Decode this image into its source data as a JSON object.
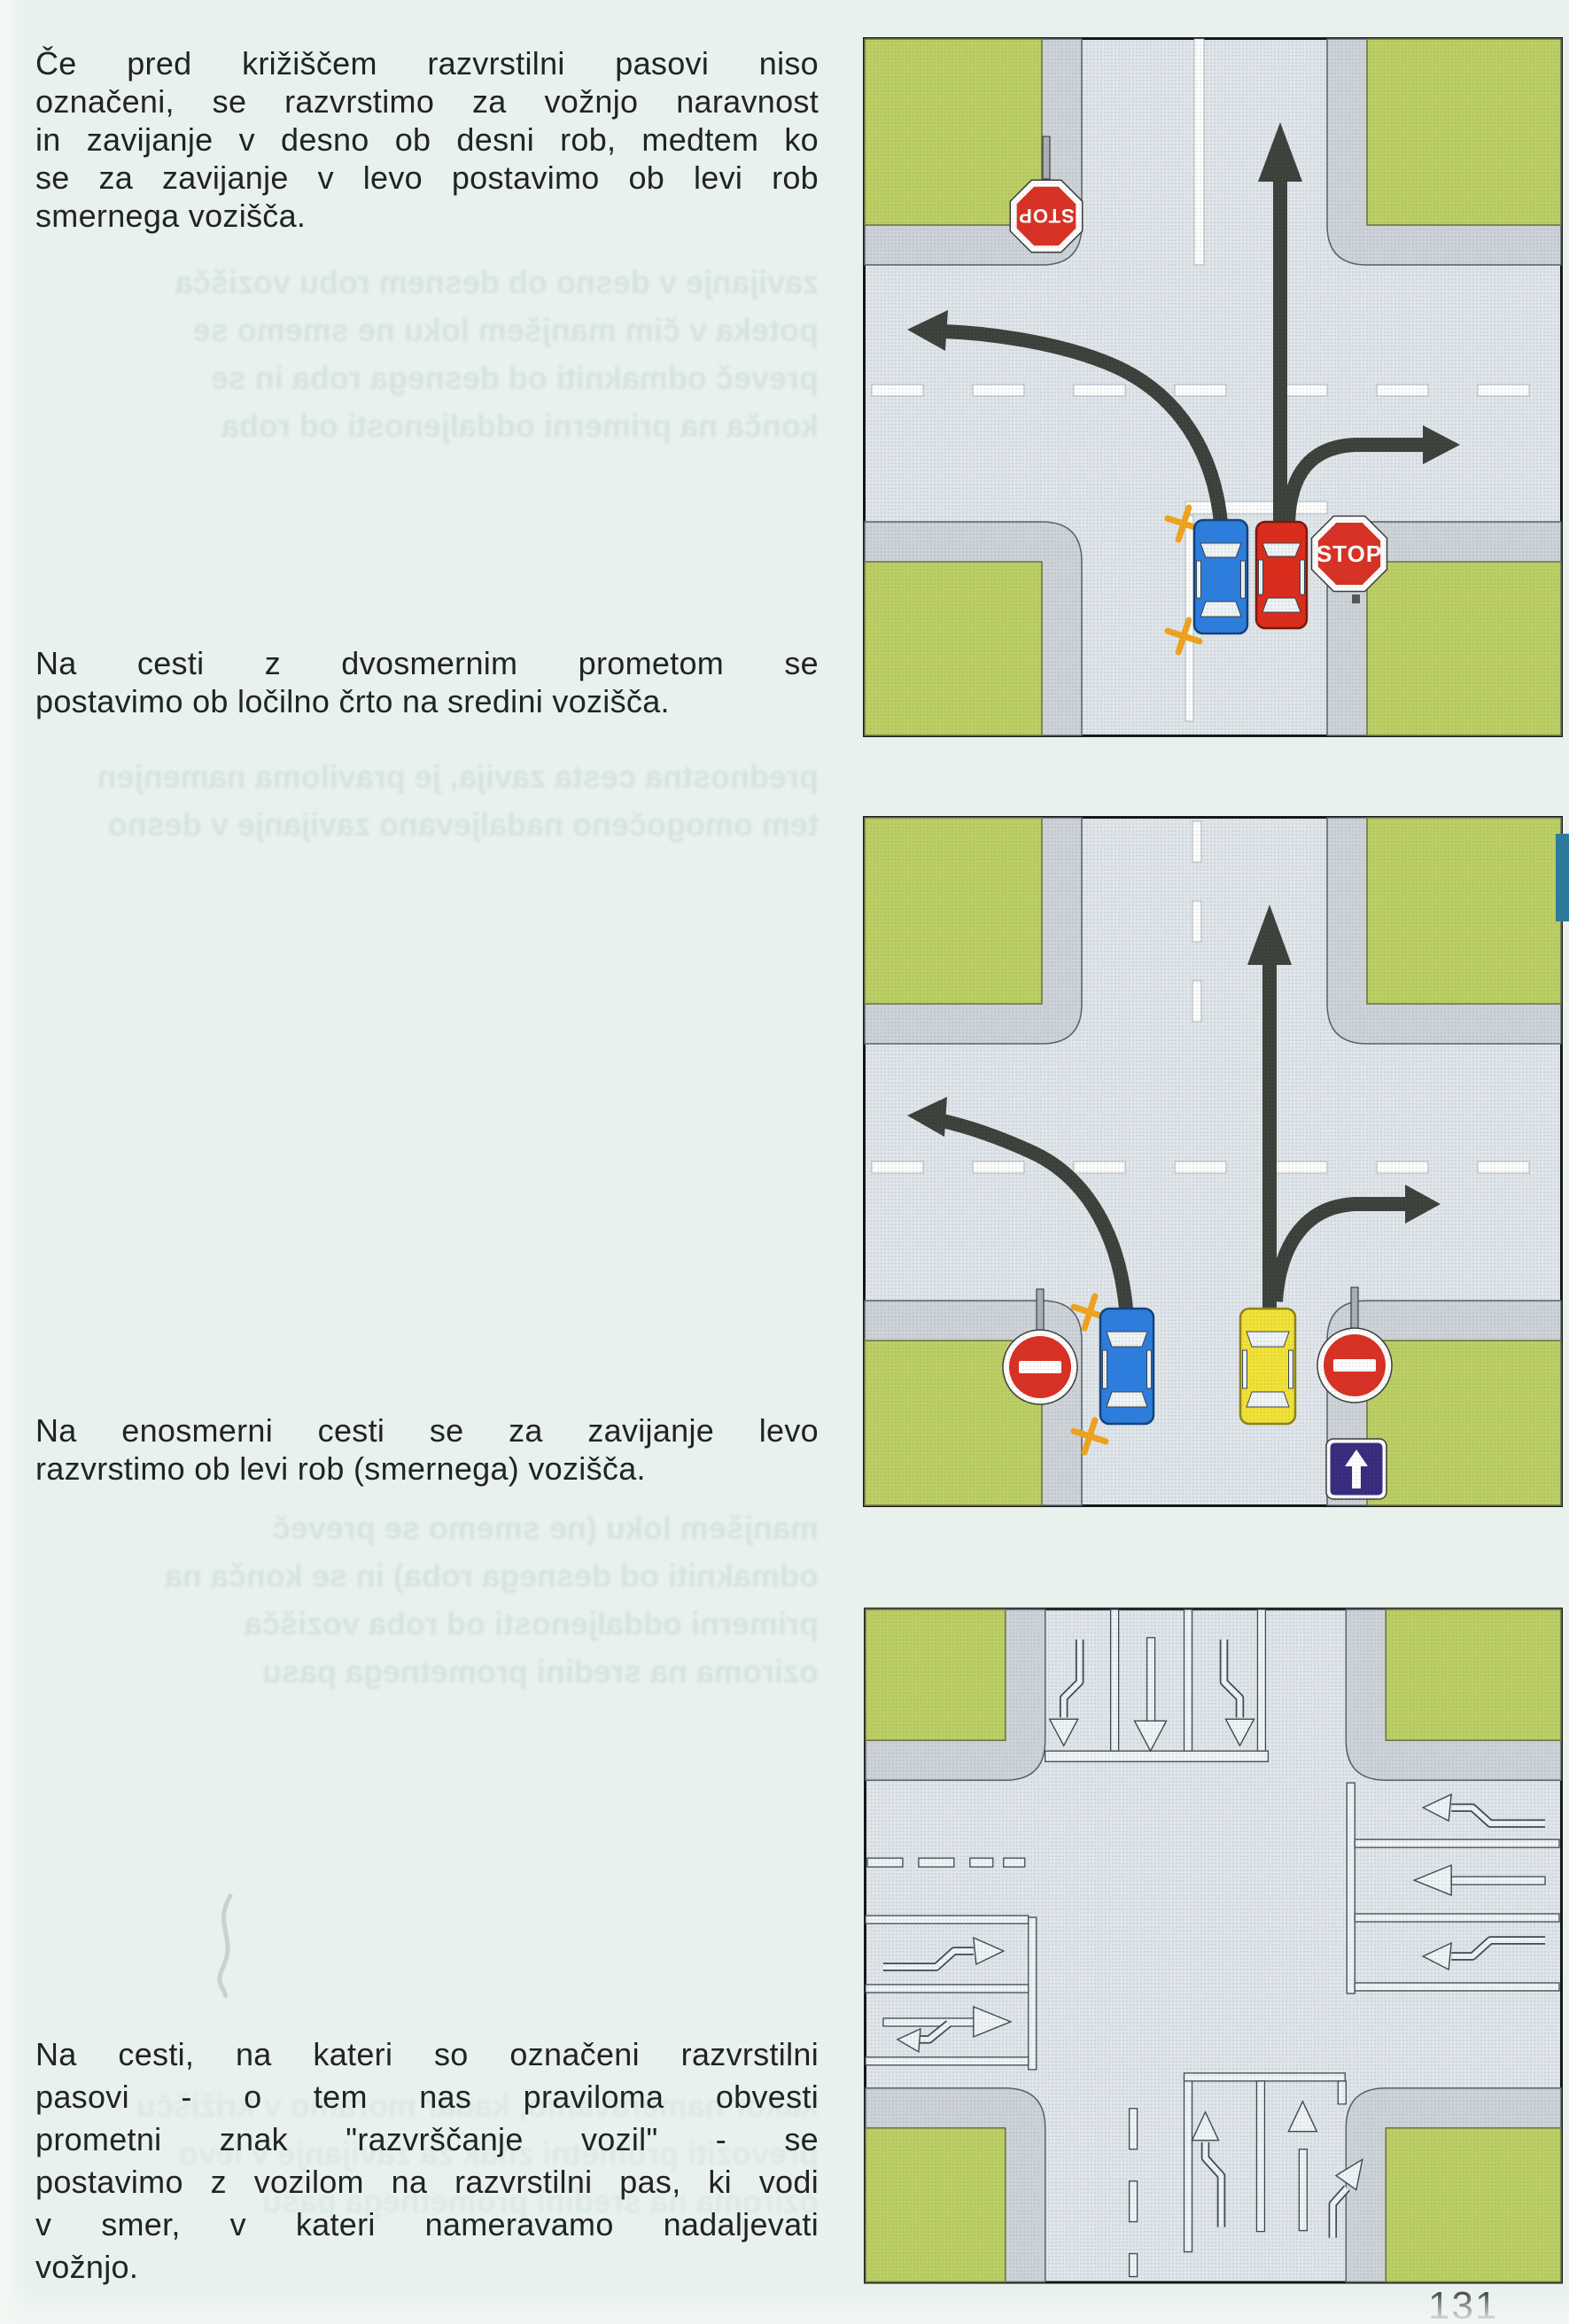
{
  "page": {
    "number": "131"
  },
  "colors": {
    "page_bg": "#e8f1ec",
    "text": "#212326",
    "ghost": "#c6dad2",
    "grass": "#bccf63",
    "road": "#dfe5ea",
    "sidewalk": "#cdd3d8",
    "arrow": "#3b403b",
    "stop_red": "#da2f23",
    "car_blue": "#2b7ddf",
    "car_red": "#dd2a1a",
    "car_yellow": "#f2e236",
    "one_way_blue": "#372a7e",
    "marking": "#eef3f6",
    "marking_edge": "#3f4752",
    "cross": "#f2a31d",
    "line_white": "#fdfdfd",
    "tab": "#2d7a9e"
  },
  "paragraphs": [
    {
      "lines": [
        "Če pred križiščem razvrstilni pasovi niso",
        "označeni, se razvrstimo za vožnjo naravnost",
        "in zavijanje v desno ob desni rob, medtem ko",
        "se za zavijanje v levo postavimo ob levi rob",
        "smernega vozišča."
      ]
    },
    {
      "lines": [
        "Na cesti z dvosmernim prometom se",
        "postavimo ob ločilno črto na sredini vozišča."
      ]
    },
    {
      "lines": [
        "Na enosmerni cesti se za zavijanje levo",
        "razvrstimo ob levi rob (smernega) vozišča."
      ]
    },
    {
      "lines": [
        "Na cesti, na kateri so označeni razvrstilni",
        "pasovi - o tem nas praviloma obvesti",
        "prometni znak \"razvrščanje vozil\" - se",
        "postavimo z vozilom na razvrstilni pas, ki vodi",
        "v smer, v kateri nameravamo nadaljevati",
        "vožnjo."
      ]
    }
  ],
  "ghosts": {
    "note": "faint mirrored bleed-through print from reverse side of the scanned page",
    "g1": [
      "zavijanje v desno ob desnem robu vozišča",
      "poteka v čim manjšem loku ne smemo se",
      "preveč odmakniti od desnega roba in se",
      "konča na primerni oddaljenosti od roba"
    ],
    "g2": [
      "prednostna cesta zavija, je praviloma namenjen",
      "tem omogočeno nadaljevano zavijanje v desno"
    ],
    "g3": [
      "manjšem loku (ne smemo se preveč",
      "odmakniti od desnega roba) in se konča na",
      "primerni oddaljenosti od roba vozišča",
      "oziroma na sredini prometnega pasu"
    ],
    "g4": [
      "kakor nameravamo, kadar moramo v križišču",
      "prevoziti prometni znak za zavijanje v levo",
      "oziroma na sredini prometnega pasu"
    ]
  },
  "diagrams": [
    {
      "name": "two-way road, unmarked lanes: blue car keeps left of centre for left turn, red car at right edge for straight/right",
      "signs": {
        "top": "STOP",
        "right": "STOP"
      },
      "cars": [
        "blue",
        "red"
      ],
      "arrows": [
        "left-turn",
        "straight",
        "right-turn"
      ]
    },
    {
      "name": "one-way street: blue car at left kerb turns left, yellow car goes straight or right",
      "signs": {
        "no_entry_left": "no-entry",
        "no_entry_right": "no-entry",
        "one_way": "one-way-up-arrow"
      },
      "cars": [
        "blue",
        "yellow"
      ],
      "arrows": [
        "left-turn",
        "straight",
        "right-turn"
      ]
    },
    {
      "name": "intersection with marked turning lanes (painted lane arrows on all four approaches)",
      "lane_arrows": {
        "north_approach": [
          "left-turn",
          "straight",
          "right-turn"
        ],
        "east_approach": [
          "turn",
          "straight",
          "turn"
        ],
        "west_approach": [
          "turn",
          "straight-or-turn"
        ],
        "south_approach": [
          "left-turn",
          "straight-or-right"
        ]
      }
    }
  ]
}
